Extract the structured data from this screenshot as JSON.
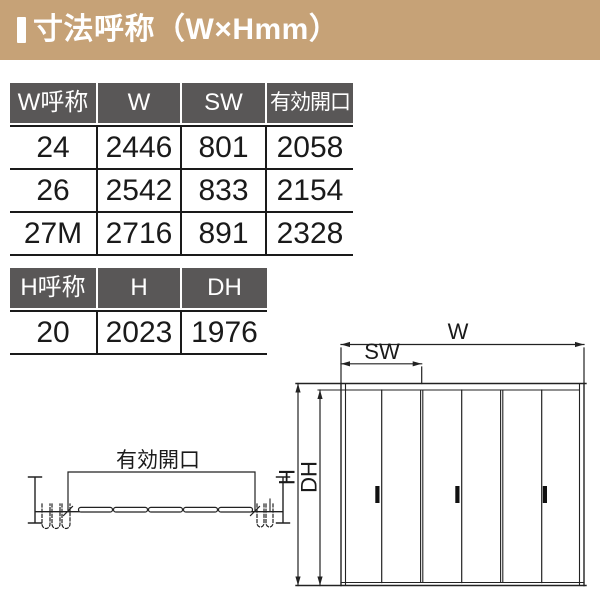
{
  "header": {
    "title": "寸法呼称（W×Hmm）",
    "accent_color": "#c6a277"
  },
  "tables": {
    "header_bg": "#595757",
    "line_color": "#1a1a1a",
    "w_table": {
      "headers": [
        "W呼称",
        "W",
        "SW",
        "有効開口"
      ],
      "rows": [
        [
          "24",
          "2446",
          "801",
          "2058"
        ],
        [
          "26",
          "2542",
          "833",
          "2154"
        ],
        [
          "27M",
          "2716",
          "891",
          "2328"
        ]
      ]
    },
    "h_table": {
      "headers": [
        "H呼称",
        "H",
        "DH"
      ],
      "rows": [
        [
          "20",
          "2023",
          "1976"
        ]
      ]
    }
  },
  "diagram": {
    "plan": {
      "opening_label": "有効開口"
    },
    "elevation": {
      "width_label": "W",
      "semi_width_label": "SW",
      "height_label": "H",
      "door_height_label": "DH",
      "panel_count": 6
    }
  }
}
